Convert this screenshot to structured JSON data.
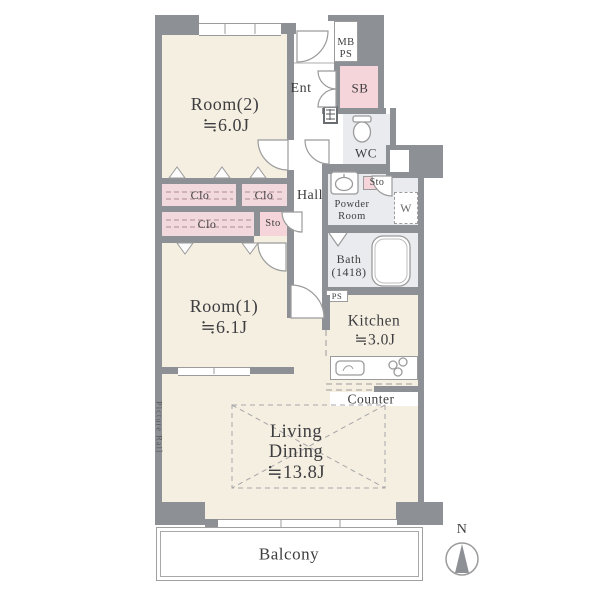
{
  "rooms": {
    "room2": {
      "name": "Room(2)",
      "size": "≒6.0J"
    },
    "room1": {
      "name": "Room(1)",
      "size": "≒6.1J"
    },
    "living_dining": {
      "line1": "Living",
      "line2": "Dining",
      "size": "≒13.8J"
    },
    "kitchen": {
      "name": "Kitchen",
      "size": "≒3.0J"
    },
    "bath": {
      "name": "Bath",
      "size_note": "(1418)"
    },
    "powder_room": {
      "line1": "Powder",
      "line2": "Room"
    },
    "wc": "WC",
    "hall": "Hall",
    "entrance": "Ent",
    "balcony": "Balcony"
  },
  "fixtures": {
    "closet": "Clo",
    "storage": "Sto",
    "shoe_box": "SB",
    "washing_machine": "W",
    "counter": "Counter",
    "meter_box": "MB",
    "pipe_space": "PS",
    "picture_rail": "Picture Rail"
  },
  "compass": {
    "north": "N"
  },
  "colors": {
    "wall": "#8d9094",
    "room_floor": "#f5efe2",
    "wet_floor": "#e9ebee",
    "closet_pink": "#f2d9dd",
    "accent_pink": "#f5d5da"
  }
}
